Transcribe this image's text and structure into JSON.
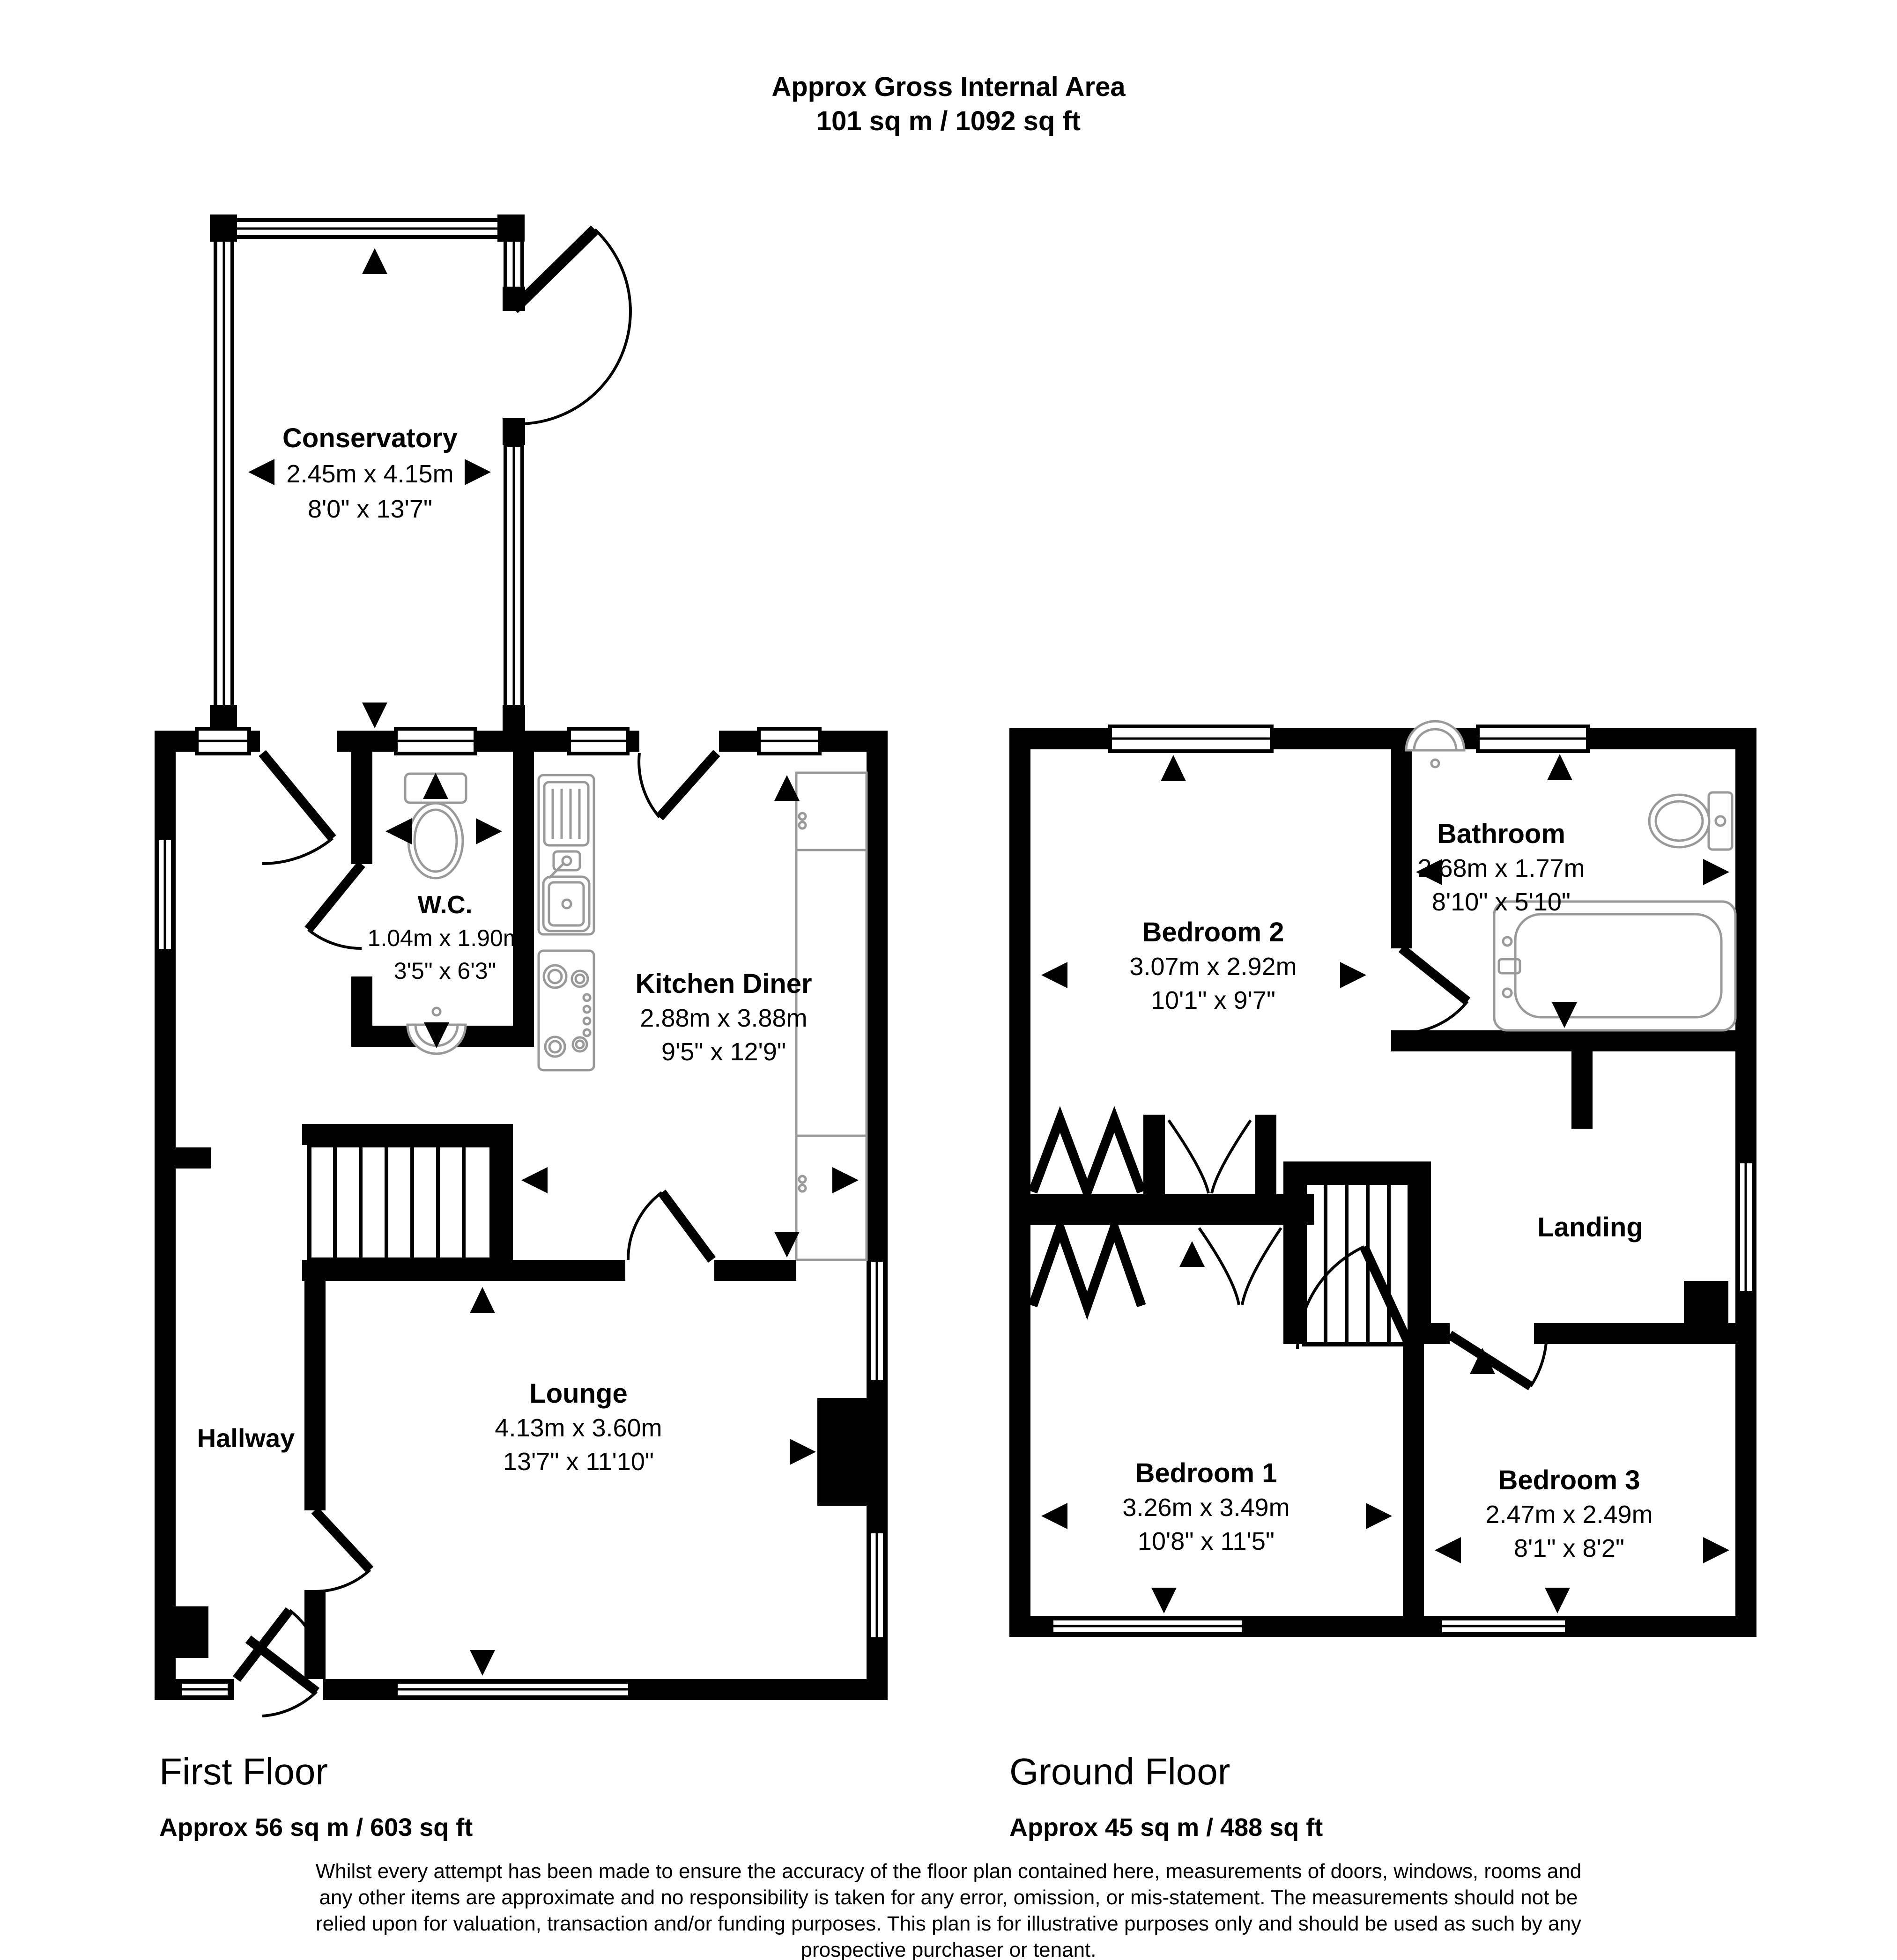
{
  "title": {
    "line1": "Approx Gross Internal Area",
    "line2": "101 sq m / 1092 sq ft"
  },
  "plans": [
    {
      "label": "First Floor",
      "area": "Approx 56 sq m / 603 sq ft",
      "rooms": [
        {
          "name": "Conservatory",
          "metric": "2.45m x 4.15m",
          "imperial": "8'0\" x 13'7\""
        },
        {
          "name": "W.C.",
          "metric": "1.04m x 1.90m",
          "imperial": "3'5\" x 6'3\""
        },
        {
          "name": "Kitchen Diner",
          "metric": "2.88m x 3.88m",
          "imperial": "9'5\" x 12'9\""
        },
        {
          "name": "Hallway"
        },
        {
          "name": "Lounge",
          "metric": "4.13m x 3.60m",
          "imperial": "13'7\" x 11'10\""
        }
      ]
    },
    {
      "label": "Ground Floor",
      "area": "Approx 45 sq m / 488 sq ft",
      "rooms": [
        {
          "name": "Bedroom 2",
          "metric": "3.07m x 2.92m",
          "imperial": "10'1\" x 9'7\""
        },
        {
          "name": "Bathroom",
          "metric": "2.68m x 1.77m",
          "imperial": "8'10\" x 5'10\""
        },
        {
          "name": "Landing"
        },
        {
          "name": "Bedroom 1",
          "metric": "3.26m x 3.49m",
          "imperial": "10'8\" x 11'5\""
        },
        {
          "name": "Bedroom 3",
          "metric": "2.47m x 2.49m",
          "imperial": "8'1\" x 8'2\""
        }
      ]
    }
  ],
  "disclaimer": {
    "line1": "Whilst every attempt has been made to ensure the accuracy of the floor plan contained here, measurements of doors, windows, rooms and",
    "line2": "any other items are approximate and no responsibility is taken for any error, omission, or mis-statement. The measurements should not be",
    "line3": "relied upon for valuation, transaction and/or funding purposes. This plan is for illustrative purposes only and should be used as such by any",
    "line4": "prospective purchaser or tenant."
  }
}
